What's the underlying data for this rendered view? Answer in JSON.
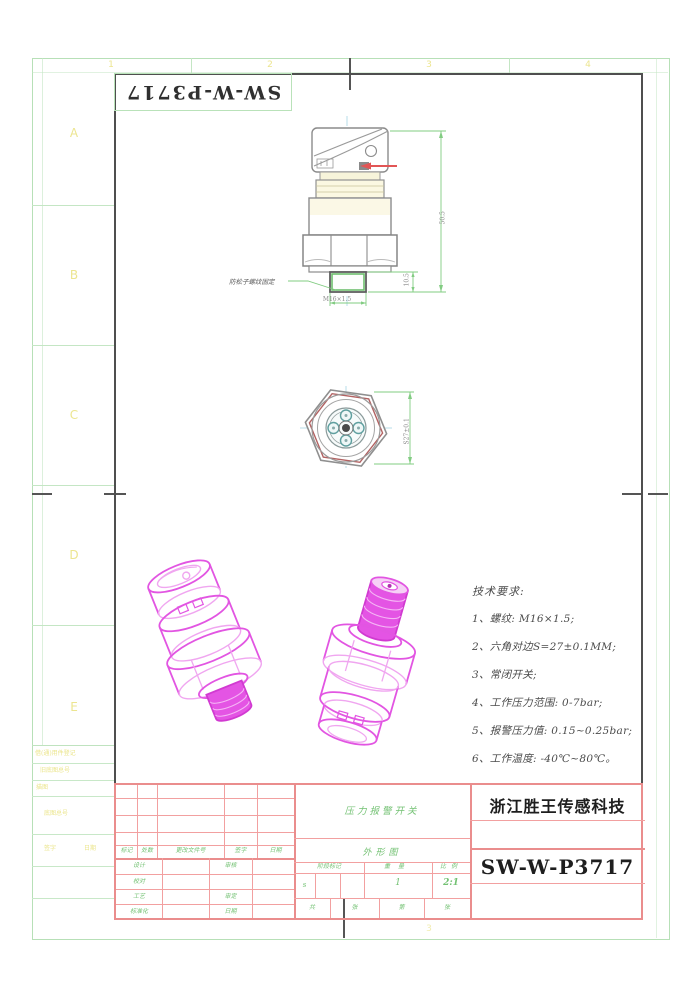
{
  "sheet": {
    "flipped_part_number": "SW-W-P3717",
    "zone_letters": [
      "A",
      "B",
      "C",
      "D",
      "E"
    ],
    "zone_numbers": [
      "1",
      "2",
      "3",
      "4"
    ]
  },
  "front_view": {
    "callout": "防松子螺纹固定",
    "dim_overall_height": "50.5",
    "dim_thread_length": "10.5",
    "dim_thread_spec": "M16×1.5"
  },
  "top_view": {
    "dim_across_flats": "S27±0.1"
  },
  "tech_requirements": {
    "title": "技术要求:",
    "lines": [
      "1、螺纹: M16×1.5;",
      "2、六角对边S=27±0.1MM;",
      "3、常闭开关;",
      "4、工作压力范围: 0-7bar;",
      "5、报警压力值: 0.15~0.25bar;",
      "6、工作温度: -40℃~80℃。"
    ]
  },
  "title_block": {
    "product_name": "压力报警开关",
    "drawing_type": "外形图",
    "company": "浙江胜王传感科技",
    "part_number": "SW-W-P3717",
    "revision_headers": [
      "标记",
      "处数",
      "更改文件号",
      "签字",
      "日期"
    ],
    "sig_labels": {
      "design": "设计",
      "check": "审核",
      "proof": "校对",
      "process": "工艺",
      "approve": "审定",
      "standard": "标准化",
      "date": "日期"
    },
    "stage_label": "阶段标记",
    "weight_label": "重量",
    "scale_label": "比例",
    "stage_value": "s",
    "weight_value": "1",
    "scale_value": "2:1",
    "sheets_total_label": "共",
    "sheets_unit1": "张",
    "sheets_no_label": "第",
    "sheets_unit2": "张"
  },
  "side_table": {
    "rows": [
      "借(通)用件登记",
      "旧底图总号",
      "描图",
      "底图总号",
      "签字",
      "日期"
    ]
  }
}
